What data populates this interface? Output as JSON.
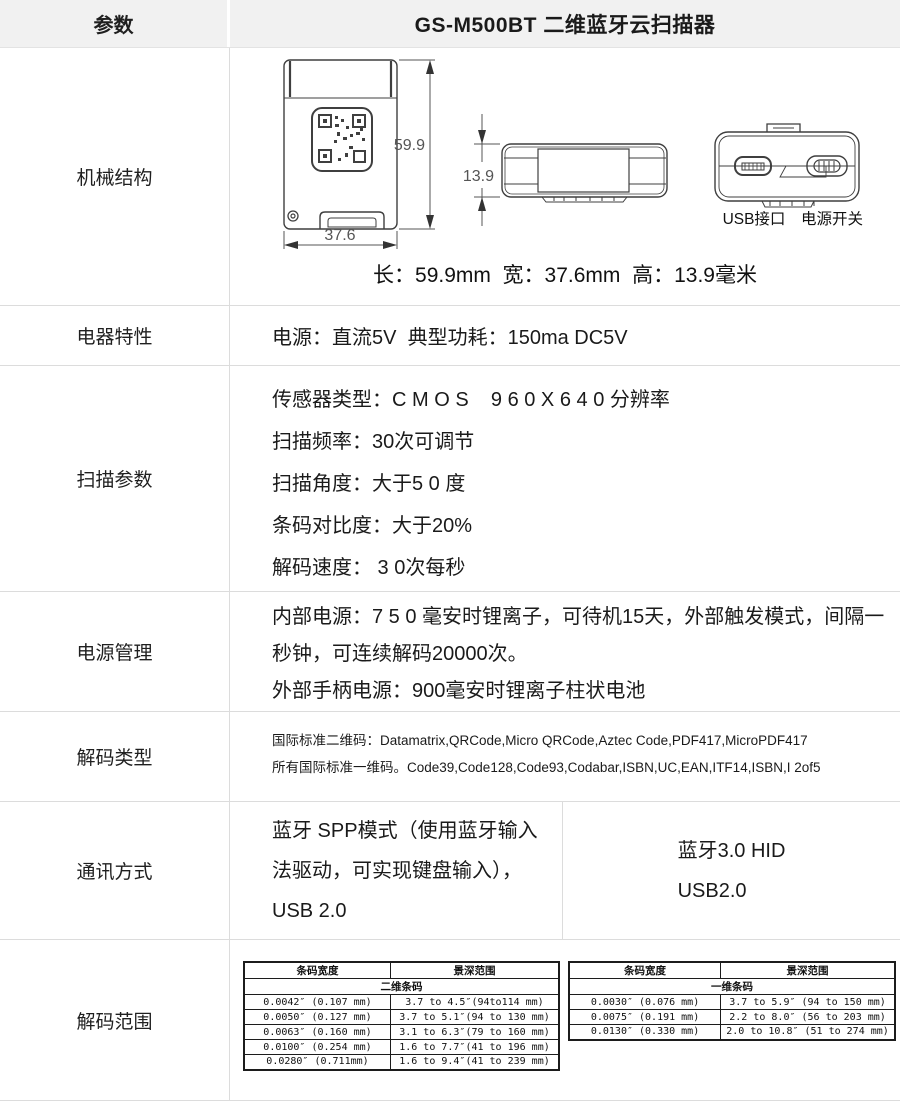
{
  "header": {
    "col1": "参数",
    "col2": "GS-M500BT 二维蓝牙云扫描器"
  },
  "mechanical": {
    "label": "机械结构",
    "dim_height_mm": "59.9",
    "dim_thickness_mm": "13.9",
    "dim_width_mm": "37.6",
    "usb_label": "USB接口",
    "switch_label": "电源开关",
    "summary": "长：59.9mm  宽：37.6mm  高：13.9毫米"
  },
  "electrical": {
    "label": "电器特性",
    "text": "电源：直流5V  典型功耗：150ma DC5V"
  },
  "scan": {
    "label": "扫描参数",
    "lines": [
      "传感器类型：C M O S    9 6 0 X 6 4 0 分辨率",
      "扫描频率：30次可调节",
      "扫描角度：大于5 0 度",
      "条码对比度：大于20%",
      "解码速度： 3 0次每秒"
    ]
  },
  "power": {
    "label": "电源管理",
    "lines": [
      "内部电源：7 5 0 毫安时锂离子，可待机15天，外部触发模式，间隔一秒钟，可连续解码20000次。",
      "外部手柄电源：900毫安时锂离子柱状电池"
    ]
  },
  "decode_types": {
    "label": "解码类型",
    "lines": [
      "国际标准二维码：Datamatrix,QRCode,Micro QRCode,Aztec Code,PDF417,MicroPDF417",
      "所有国际标准一维码。Code39,Code128,Code93,Codabar,ISBN,UC,EAN,ITF14,ISBN,I 2of5"
    ]
  },
  "communication": {
    "label": "通讯方式",
    "left_text": "蓝牙 SPP模式（使用蓝牙输入法驱动，可实现键盘输入），USB 2.0",
    "right_lines": [
      "蓝牙3.0 HID",
      "USB2.0"
    ]
  },
  "decode_range": {
    "label": "解码范围",
    "tables": [
      {
        "col_headers": [
          "条码宽度",
          "景深范围"
        ],
        "group": "二维条码",
        "rows": [
          [
            "0.0042″ (0.107 mm)",
            "3.7 to 4.5″(94to114 mm)"
          ],
          [
            "0.0050″ (0.127 mm)",
            "3.7 to 5.1″(94 to 130 mm)"
          ],
          [
            "0.0063″ (0.160 mm)",
            "3.1 to 6.3″(79 to 160 mm)"
          ],
          [
            "0.0100″ (0.254 mm)",
            "1.6 to 7.7″(41 to 196 mm)"
          ],
          [
            "0.0280″  (0.711mm)",
            "1.6 to 9.4″(41 to 239 mm)"
          ]
        ]
      },
      {
        "col_headers": [
          "条码宽度",
          "景深范围"
        ],
        "group": "一维条码",
        "rows": [
          [
            "0.0030″ (0.076 mm)",
            "3.7 to 5.9″ (94 to 150 mm)"
          ],
          [
            "0.0075″ (0.191 mm)",
            "2.2 to 8.0″ (56 to 203 mm)"
          ],
          [
            "0.0130″ (0.330 mm)",
            "2.0 to 10.8″ (51 to 274 mm)"
          ]
        ]
      }
    ]
  },
  "colors": {
    "header_bg": "#f1f1f1",
    "grid_border": "#dcdcdc",
    "table_border": "#1c1c1c",
    "text": "#1a1a1a",
    "drawing_stroke": "#3f3f3f",
    "dimension_text": "#555555"
  }
}
